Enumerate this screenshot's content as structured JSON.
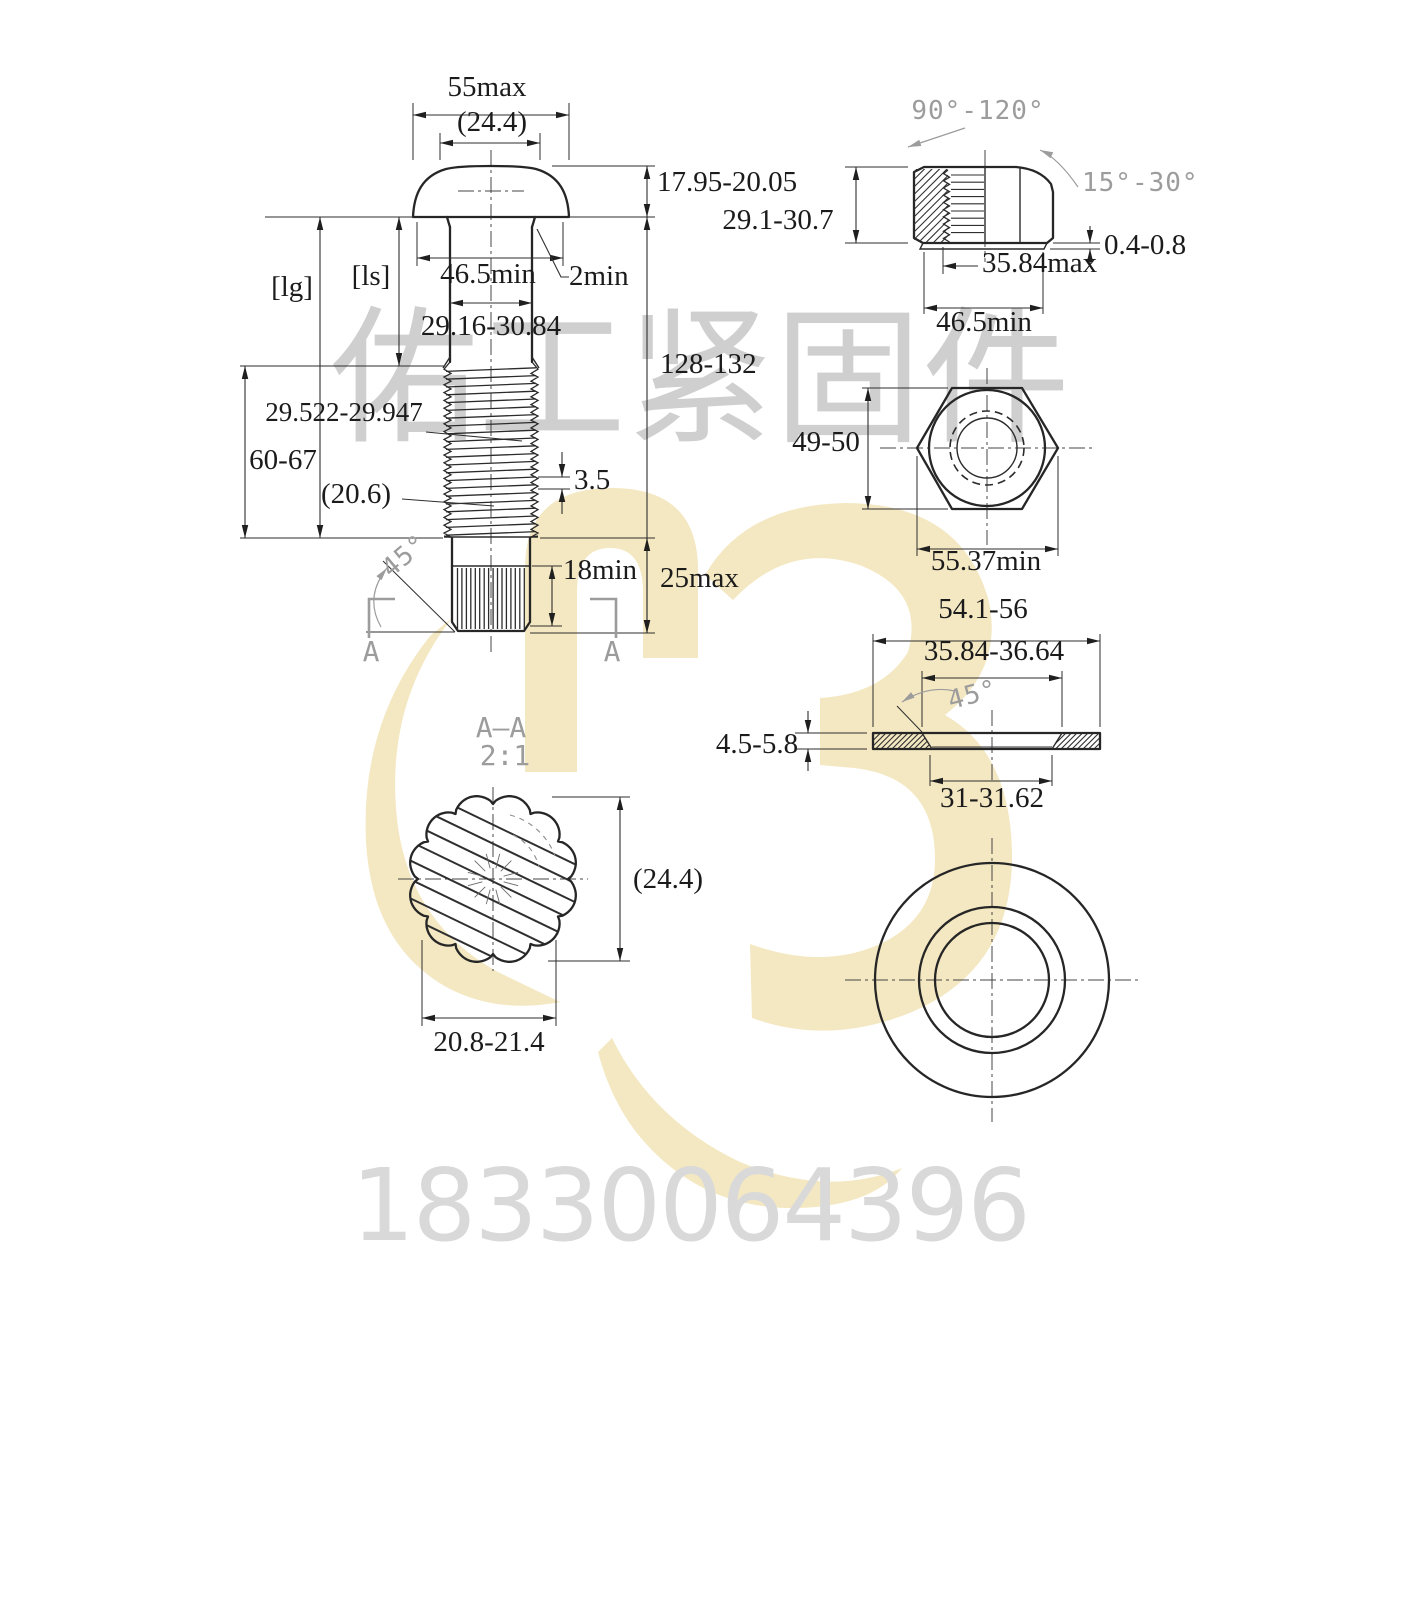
{
  "colors": {
    "logo": "#f4e8c2",
    "line": "#262626",
    "annotation_gray": "#9c9c9c",
    "watermark_text": "#bfbfbf",
    "phone_text": "#d9d9d9"
  },
  "bolt": {
    "total_width": "55max",
    "head_top_dia": "(24.4)",
    "head_height": "17.95-20.05",
    "grip_label": "[lg]",
    "shank_label": "[ls]",
    "bearing_dia": "46.5min",
    "fillet_min": "2min",
    "shank_dia": "29.16-30.84",
    "pitch_dia": "29.522-29.947",
    "thread_length": "60-67",
    "minor_dia": "(20.6)",
    "thread_pitch": "3.5",
    "overall_length": "128-132",
    "chamfer_angle": "45°",
    "spline_length": "18min",
    "point_length": "25max",
    "section_letter_left": "A",
    "section_letter_right": "A"
  },
  "nut": {
    "top_chamfer_angle": "90°-120°",
    "washer_face_angle": "15°-30°",
    "height": "29.1-30.7",
    "washer_face_height": "0.4-0.8",
    "thread_dia": "35.84max",
    "bearing_dia": "46.5min",
    "across_flats": "49-50",
    "across_corners": "55.37min"
  },
  "washer": {
    "outer_dia": "54.1-56",
    "top_bearing_dia": "35.84-36.64",
    "chamfer_angle": "45°",
    "thickness": "4.5-5.8",
    "hole_dia": "31-31.62"
  },
  "section": {
    "title": "A—A",
    "scale": "2:1",
    "spline_major": "(24.4)",
    "spline_minor": "20.8-21.4"
  },
  "watermark": {
    "company": "佑工紧固件",
    "phone": "18330064396"
  }
}
